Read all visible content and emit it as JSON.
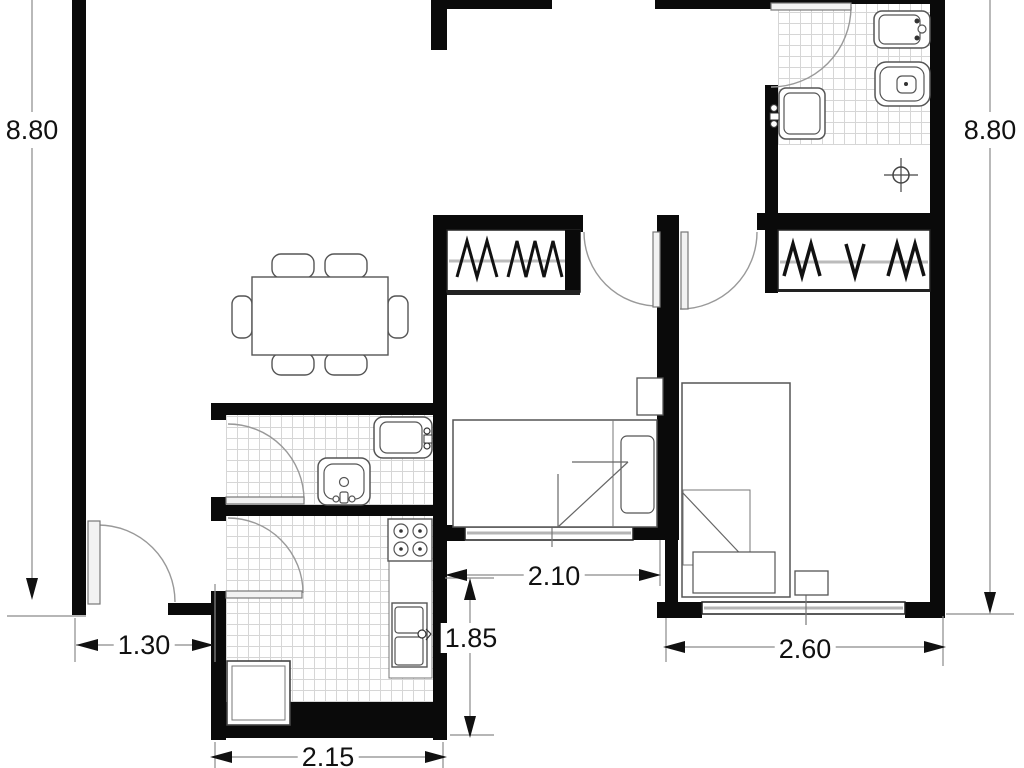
{
  "type": "apartment-floor-plan",
  "units": "meters",
  "labels": {
    "left_height": "8.80",
    "right_height": "8.80",
    "entry_width": "1.30",
    "kitchen_width": "2.15",
    "kitchen_depth": "1.85",
    "bedroom1_width": "2.10",
    "bedroom2_width": "2.60"
  },
  "colors": {
    "wall": "#0a0a0a",
    "furniture_line": "#555555",
    "dimension_line": "#8a8a8a",
    "tile_line": "#d6d6d6",
    "window_glass": "#b5b5b5",
    "background": "#ffffff",
    "text": "#111111"
  }
}
